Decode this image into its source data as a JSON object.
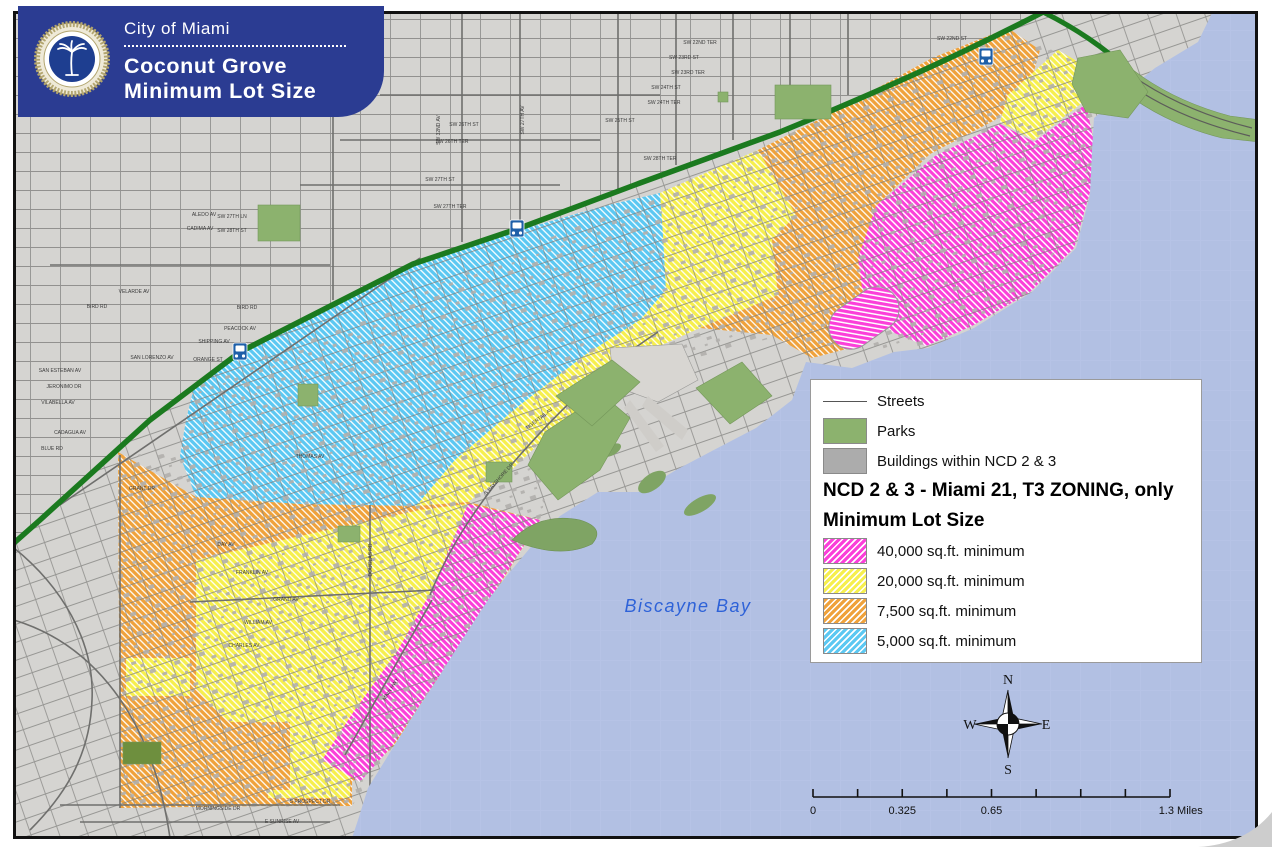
{
  "header": {
    "agency": "City of Miami",
    "title_line1": "Coconut Grove",
    "title_line2": "Minimum Lot Size",
    "seal": "city-of-miami-seal"
  },
  "legend": {
    "simple_items": [
      {
        "label": "Streets",
        "symbol": "line"
      },
      {
        "label": "Parks",
        "color": "#8CB26E"
      },
      {
        "label": "Buildings within NCD 2 & 3",
        "color": "#ACACAC"
      }
    ],
    "heading1": "NCD 2 & 3 - Miami 21, T3 ZONING, only",
    "heading2": "Minimum Lot Size",
    "zone_items": [
      {
        "label": "40,000 sq.ft. minimum",
        "color": "#FB3FD9"
      },
      {
        "label": "20,000 sq.ft. minimum",
        "color": "#F6EF4E"
      },
      {
        "label": "7,500 sq.ft. minimum",
        "color": "#EFA23C"
      },
      {
        "label": "5,000 sq.ft. minimum",
        "color": "#5CC8F2"
      }
    ]
  },
  "map": {
    "water_label": "Biscayne Bay",
    "metro_stations": [
      [
        240,
        352
      ],
      [
        517,
        229
      ],
      [
        986,
        57
      ]
    ],
    "street_labels": [
      {
        "t": "SW 22ND ST",
        "x": 952,
        "y": 40,
        "r": 0
      },
      {
        "t": "SW 22ND TER",
        "x": 700,
        "y": 44,
        "r": 0
      },
      {
        "t": "SW 23RD ST",
        "x": 684,
        "y": 59,
        "r": 0
      },
      {
        "t": "SW 23RD TER",
        "x": 688,
        "y": 74,
        "r": 0
      },
      {
        "t": "SW 24TH ST",
        "x": 666,
        "y": 89,
        "r": 0
      },
      {
        "t": "SW 24TH TER",
        "x": 664,
        "y": 104,
        "r": 0
      },
      {
        "t": "SW 25TH ST",
        "x": 620,
        "y": 122,
        "r": 0
      },
      {
        "t": "SW 26TH ST",
        "x": 464,
        "y": 126,
        "r": 0
      },
      {
        "t": "SW 26TH TER",
        "x": 452,
        "y": 143,
        "r": 0
      },
      {
        "t": "SW 27TH ST",
        "x": 440,
        "y": 181,
        "r": 0
      },
      {
        "t": "SW 27TH TER",
        "x": 450,
        "y": 208,
        "r": 0
      },
      {
        "t": "SW 28TH TER",
        "x": 660,
        "y": 160,
        "r": 0
      },
      {
        "t": "SW 27TH LN",
        "x": 232,
        "y": 218,
        "r": 0
      },
      {
        "t": "SW 28TH ST",
        "x": 232,
        "y": 232,
        "r": 0
      },
      {
        "t": "ALEDO AV",
        "x": 204,
        "y": 216,
        "r": 0
      },
      {
        "t": "CADIMA AV",
        "x": 200,
        "y": 230,
        "r": 0
      },
      {
        "t": "VELARDE AV",
        "x": 134,
        "y": 293,
        "r": 0
      },
      {
        "t": "BIRD RD",
        "x": 97,
        "y": 308,
        "r": 0
      },
      {
        "t": "BIRD RD",
        "x": 247,
        "y": 309,
        "r": 0
      },
      {
        "t": "PEACOCK AV",
        "x": 240,
        "y": 330,
        "r": 0
      },
      {
        "t": "SHIPPING AV",
        "x": 214,
        "y": 343,
        "r": 0
      },
      {
        "t": "ORANGE ST",
        "x": 208,
        "y": 361,
        "r": 0
      },
      {
        "t": "SAN LORENZO AV",
        "x": 152,
        "y": 359,
        "r": 0
      },
      {
        "t": "SAN ESTEBAN AV",
        "x": 60,
        "y": 372,
        "r": 0
      },
      {
        "t": "JERONIMO DR",
        "x": 64,
        "y": 388,
        "r": 0
      },
      {
        "t": "VILABELLA AV",
        "x": 58,
        "y": 404,
        "r": 0
      },
      {
        "t": "CADAGUA AV",
        "x": 70,
        "y": 434,
        "r": 0
      },
      {
        "t": "BLUE RD",
        "x": 52,
        "y": 450,
        "r": 0
      },
      {
        "t": "GRANT DR",
        "x": 142,
        "y": 490,
        "r": 0
      },
      {
        "t": "SW 27TH AV",
        "x": 524,
        "y": 120,
        "r": -90
      },
      {
        "t": "SW 32ND AV",
        "x": 440,
        "y": 130,
        "r": -90
      },
      {
        "t": "TIGERTAIL AV",
        "x": 540,
        "y": 420,
        "r": -38
      },
      {
        "t": "S BAYSHORE DR",
        "x": 500,
        "y": 480,
        "r": -48
      },
      {
        "t": "THOMAS AV",
        "x": 310,
        "y": 458,
        "r": 0
      },
      {
        "t": "DAY AV",
        "x": 226,
        "y": 546,
        "r": 0
      },
      {
        "t": "FRANKLIN AV",
        "x": 252,
        "y": 574,
        "r": 0
      },
      {
        "t": "GRAND AV",
        "x": 286,
        "y": 601,
        "r": 0
      },
      {
        "t": "WILLIAM AV",
        "x": 258,
        "y": 624,
        "r": 0
      },
      {
        "t": "CHARLES AV",
        "x": 244,
        "y": 647,
        "r": 0
      },
      {
        "t": "MAIN HWY",
        "x": 392,
        "y": 690,
        "r": -58
      },
      {
        "t": "DOUGLAS RD",
        "x": 372,
        "y": 560,
        "r": -90
      },
      {
        "t": "MORNINGSIDE DR",
        "x": 218,
        "y": 810,
        "r": 0
      },
      {
        "t": "S PROSPECT DR",
        "x": 310,
        "y": 803,
        "r": 0
      },
      {
        "t": "E SUNRISE AV",
        "x": 282,
        "y": 823,
        "r": 0
      }
    ]
  },
  "scale_bar": {
    "x": 813,
    "y": 797,
    "width": 357,
    "segments": 8,
    "labels": [
      {
        "text": "0",
        "frac": 0
      },
      {
        "text": "0.325",
        "frac": 0.25
      },
      {
        "text": "0.65",
        "frac": 0.5
      },
      {
        "text": "1.3 Miles",
        "frac": 1.03
      }
    ]
  },
  "compass": {
    "n": "N",
    "s": "S",
    "e": "E",
    "w": "W"
  },
  "colors": {
    "water": "#B2C0E3",
    "land": "#D5D4D1",
    "street": "#8A8A88",
    "highway_green": "#1B7A1F",
    "park_green": "#8CB26E",
    "title_bg": "#2B3C92",
    "zone_40000": "#FB3FD9",
    "zone_20000": "#F6EF4E",
    "zone_7500": "#EFA23C",
    "zone_5000": "#5CC8F2",
    "building_gray": "#B1AFAC"
  }
}
